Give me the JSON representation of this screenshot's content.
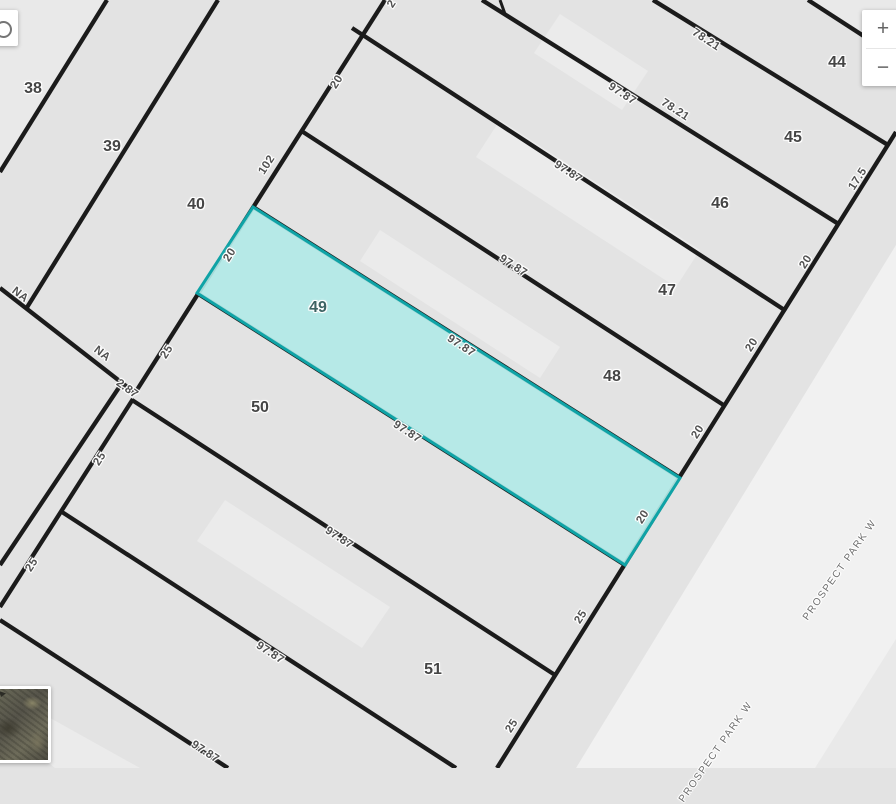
{
  "map": {
    "highlighted_parcel": "49",
    "colors": {
      "parcel_fill": "#e3e3e3",
      "roadway_fill": "#f1f1f1",
      "lot_line": "#1b1b1b",
      "highlight_fill": "#b2e9e7",
      "highlight_stroke": "#0fa3a6"
    },
    "parcel_labels": [
      {
        "id": "38",
        "x": 33,
        "y": 89
      },
      {
        "id": "39",
        "x": 112,
        "y": 147
      },
      {
        "id": "40",
        "x": 196,
        "y": 205
      },
      {
        "id": "44",
        "x": 837,
        "y": 63
      },
      {
        "id": "45",
        "x": 793,
        "y": 138
      },
      {
        "id": "46",
        "x": 720,
        "y": 204
      },
      {
        "id": "47",
        "x": 667,
        "y": 291
      },
      {
        "id": "48",
        "x": 612,
        "y": 377
      },
      {
        "id": "49",
        "x": 318,
        "y": 308,
        "highlighted": true
      },
      {
        "id": "50",
        "x": 260,
        "y": 408
      },
      {
        "id": "51",
        "x": 433,
        "y": 670
      }
    ],
    "dimension_labels": [
      {
        "t": "78.21",
        "x": 706,
        "y": 40,
        "r": 33
      },
      {
        "t": "97.87",
        "x": 622,
        "y": 94,
        "r": 33
      },
      {
        "t": "78.21",
        "x": 675,
        "y": 110,
        "r": 33
      },
      {
        "t": "97.87",
        "x": 568,
        "y": 172,
        "r": 33
      },
      {
        "t": "97.87",
        "x": 513,
        "y": 266,
        "r": 33
      },
      {
        "t": "97.87",
        "x": 461,
        "y": 346,
        "r": 33
      },
      {
        "t": "97.87",
        "x": 407,
        "y": 432,
        "r": 33
      },
      {
        "t": "97.87",
        "x": 339,
        "y": 538,
        "r": 33
      },
      {
        "t": "97.87",
        "x": 270,
        "y": 653,
        "r": 33
      },
      {
        "t": "97.87",
        "x": 205,
        "y": 752,
        "r": 33
      },
      {
        "t": "17.5",
        "x": 858,
        "y": 179,
        "r": -57
      },
      {
        "t": "20",
        "x": 806,
        "y": 262,
        "r": -57
      },
      {
        "t": "20",
        "x": 752,
        "y": 345,
        "r": -57
      },
      {
        "t": "20",
        "x": 698,
        "y": 432,
        "r": -57
      },
      {
        "t": "20",
        "x": 643,
        "y": 517,
        "r": -57
      },
      {
        "t": "25",
        "x": 581,
        "y": 617,
        "r": -57
      },
      {
        "t": "25",
        "x": 512,
        "y": 726,
        "r": -57
      },
      {
        "t": "2",
        "x": 392,
        "y": 4,
        "r": -57
      },
      {
        "t": "20",
        "x": 337,
        "y": 82,
        "r": -57
      },
      {
        "t": "102",
        "x": 267,
        "y": 165,
        "r": -57
      },
      {
        "t": "20",
        "x": 230,
        "y": 255,
        "r": -57
      },
      {
        "t": "25",
        "x": 167,
        "y": 352,
        "r": -57
      },
      {
        "t": "25",
        "x": 100,
        "y": 459,
        "r": -57
      },
      {
        "t": "25",
        "x": 32,
        "y": 565,
        "r": -57
      },
      {
        "t": "2.87",
        "x": 127,
        "y": 389,
        "r": 36
      },
      {
        "t": "NA",
        "x": 20,
        "y": 295,
        "r": 38
      },
      {
        "t": "NA",
        "x": 102,
        "y": 354,
        "r": 38
      }
    ],
    "street_labels": [
      {
        "name": "PROSPECT PARK W",
        "x": 840,
        "y": 570,
        "r": -55
      },
      {
        "name": "PROSPECT PARK W",
        "x": 716,
        "y": 752,
        "r": -55
      }
    ]
  },
  "controls": {
    "zoom_in_label": "+",
    "zoom_out_label": "−",
    "search_icon": "magnifier-icon",
    "minimap_thumbnail": "satellite-thumbnail"
  }
}
